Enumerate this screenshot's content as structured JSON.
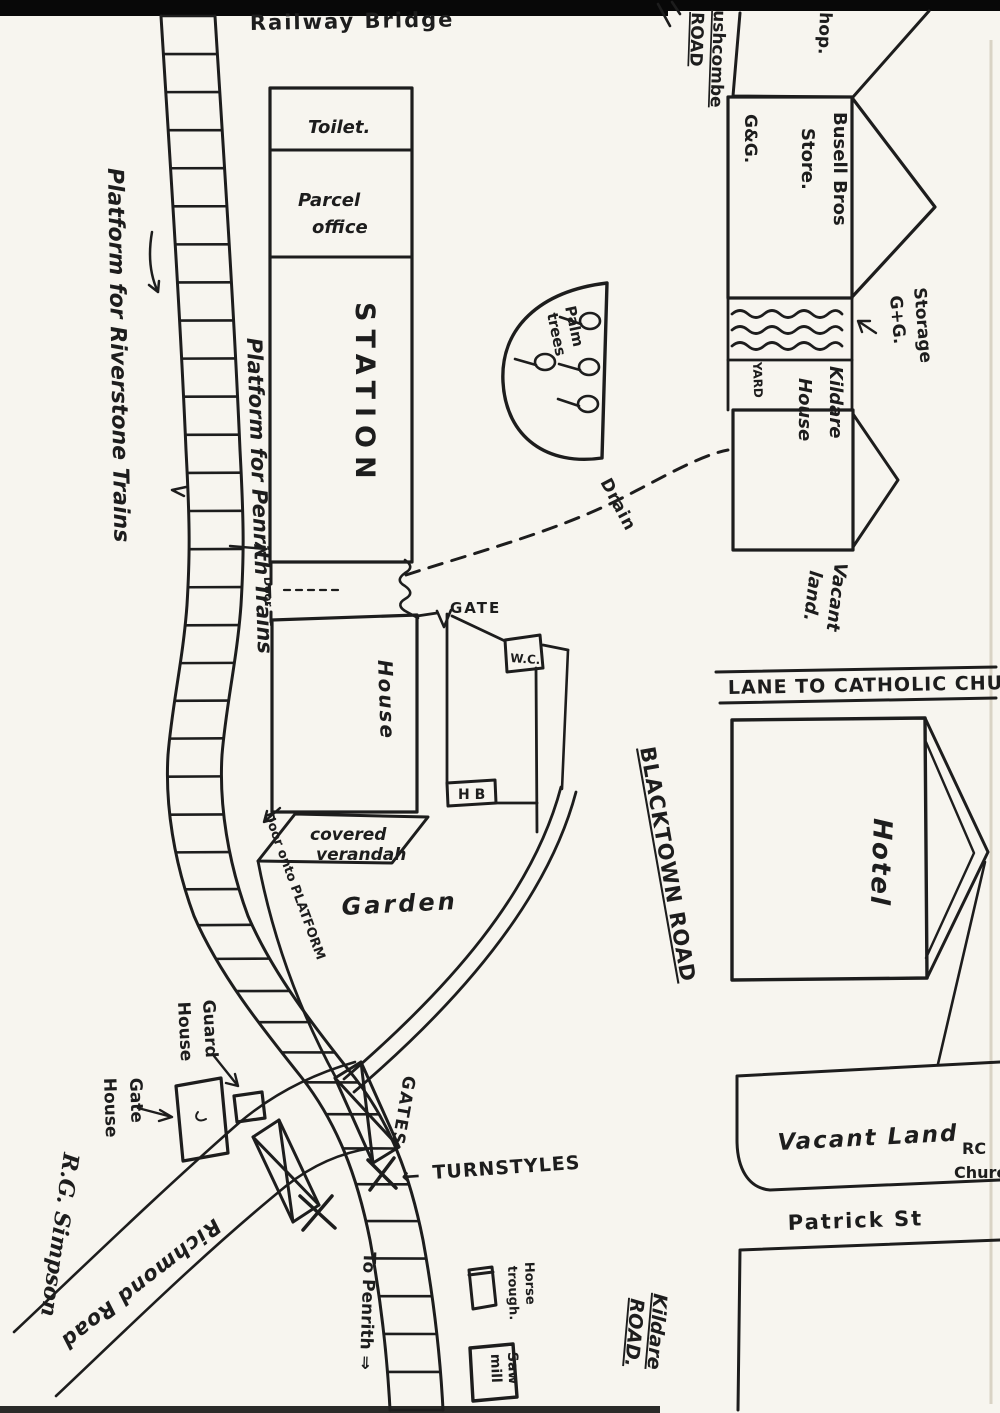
{
  "colors": {
    "ink": "#1d1d1d",
    "paper": "#f7f5ef",
    "scan_bar": "#080808"
  },
  "labels": {
    "railway_bridge": "Railway Bridge",
    "platform_riverstone": "Platform for Riverstone Trains",
    "platform_penrith": "Platform for Penrith Trains",
    "toilet": "Toilet.",
    "parcel_office_1": "Parcel",
    "parcel_office_2": "office",
    "station": "STATION",
    "door": "Door",
    "gate_station": "GATE",
    "wc": "W.C.",
    "house": "House",
    "hb": "H B",
    "covered_verandah_1": "covered",
    "covered_verandah_2": "verandah",
    "door_onto_platform": "Door onto PLATFORM",
    "garden": "Garden",
    "palm_trees_1": "Palm",
    "palm_trees_2": "trees",
    "drain": "Drain",
    "guard_house_1": "Guard",
    "guard_house_2": "House",
    "gate_house_1": "Gate",
    "gate_house_2": "House",
    "gates": "GATES",
    "turnstyles_arrow": "←",
    "turnstyles": "TURNSTYLES",
    "richmond_road": "Richmond Road",
    "signature": "R.G. Simpson",
    "to_penrith": "To Penrith ⇒",
    "horse_trough_1": "Horse",
    "horse_trough_2": "trough.",
    "saw_mill_1": "Saw",
    "saw_mill_2": "mill",
    "kildare_road_1": "Kildare",
    "kildare_road_2": "ROAD.",
    "blacktown_road": "BLACKTOWN ROAD",
    "lane_to_church": "LANE TO CATHOLIC CHURCH",
    "hotel": "Hotel",
    "vacant_land_south": "Vacant Land",
    "rc_church_1": "RC",
    "rc_church_2": "Church",
    "patrick_st": "Patrick St",
    "bushcombe_road_1": "ushcombe",
    "bushcombe_road_2": "ROAD",
    "shop": "hop.",
    "gg": "G&G.",
    "busell_1": "Busell Bros",
    "busell_2": "Store.",
    "storage_1": "Storage",
    "storage_2": "G+G.",
    "yard": "YARD",
    "kildare_house_1": "Kildare",
    "kildare_house_2": "House",
    "vacant_land_east_1": "Vacant",
    "vacant_land_east_2": "land."
  }
}
